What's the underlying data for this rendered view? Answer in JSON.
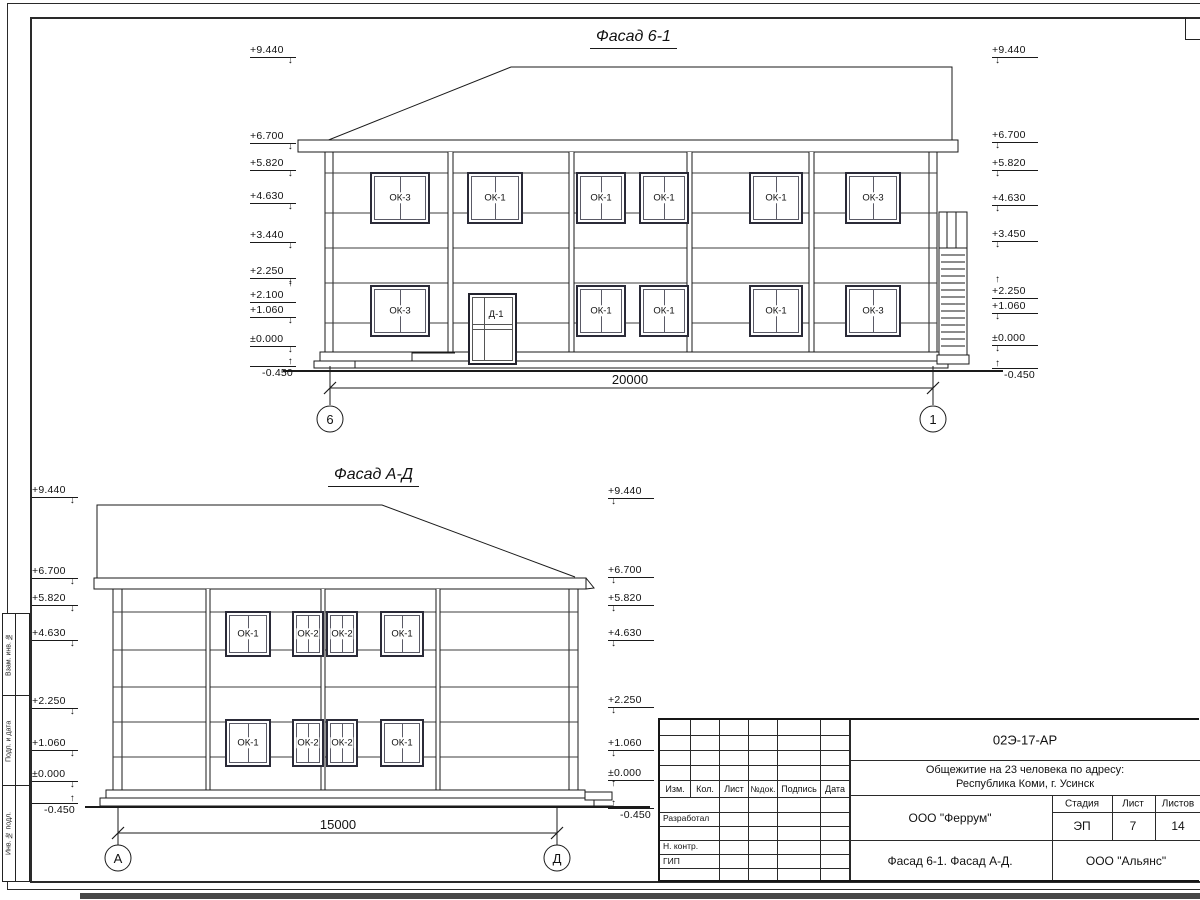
{
  "sheet": {
    "side_labels": [
      "Взам. инв. №",
      "Подп. и дата",
      "Инв. № подл."
    ]
  },
  "facade1": {
    "title": "Фасад 6-1",
    "dimension": "20000",
    "axis_left": "6",
    "axis_right": "1",
    "marks_left": [
      "+9.440",
      "+6.700",
      "+5.820",
      "+4.630",
      "+3.440",
      "+2.250",
      "+2.100",
      "+1.060",
      "±0.000",
      "-0.450"
    ],
    "marks_right": [
      "+9.440",
      "+6.700",
      "+5.820",
      "+4.630",
      "+3.450",
      "+2.250",
      "+1.060",
      "±0.000",
      "-0.450"
    ],
    "windows_f2": [
      "ОК-3",
      "ОК-1",
      "ОК-1",
      "ОК-1",
      "ОК-1",
      "ОК-3"
    ],
    "windows_f1": [
      "ОК-3",
      "ОК-1",
      "ОК-1",
      "ОК-1",
      "ОК-3"
    ],
    "door": "Д-1"
  },
  "facade2": {
    "title": "Фасад А-Д",
    "dimension": "15000",
    "axis_left": "А",
    "axis_right": "Д",
    "marks_left": [
      "+9.440",
      "+6.700",
      "+5.820",
      "+4.630",
      "+2.250",
      "+1.060",
      "±0.000",
      "-0.450"
    ],
    "marks_right": [
      "+9.440",
      "+6.700",
      "+5.820",
      "+4.630",
      "+2.250",
      "+1.060",
      "±0.000",
      "-0.450"
    ],
    "windows_f2": [
      "ОК-1",
      "ОК-2",
      "ОК-2",
      "ОК-1"
    ],
    "windows_f1": [
      "ОК-1",
      "ОК-2",
      "ОК-2",
      "ОК-1"
    ]
  },
  "titleblock": {
    "code": "02Э-17-АР",
    "project_line1": "Общежитие на 23 человека по адресу:",
    "project_line2": "Республика Коми, г. Усинск",
    "designer": "ООО \"Феррум\"",
    "stage_label": "Стадия",
    "sheet_label": "Лист",
    "sheets_label": "Листов",
    "stage": "ЭП",
    "sheet": "7",
    "sheets": "14",
    "drawing_title": "Фасад 6-1. Фасад  А-Д.",
    "contractor": "ООО \"Альянс\"",
    "cols": [
      "Изм.",
      "Кол.",
      "Лист",
      "№док.",
      "Подпись",
      "Дата"
    ],
    "rows": [
      "Разработал",
      "Н. контр.",
      "ГИП"
    ]
  }
}
